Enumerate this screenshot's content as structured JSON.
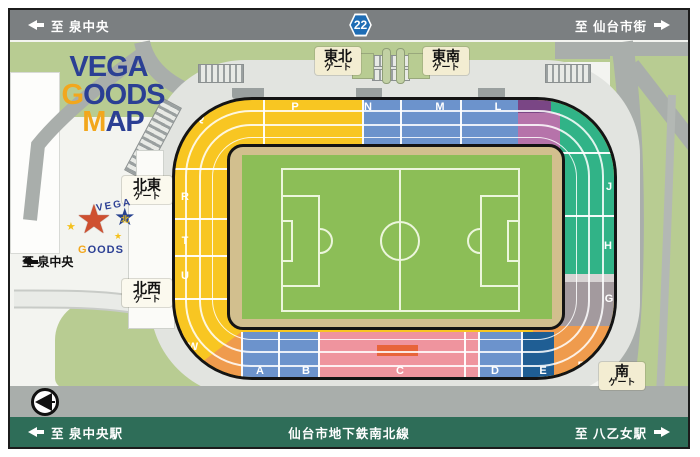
{
  "top_bar": {
    "left_label": "至 泉中央",
    "route_number": "22",
    "right_label": "至 仙台市街"
  },
  "map_title": {
    "vega": "VEGA",
    "g": "G",
    "oods": "OODS",
    "m": "M",
    "ap": "AP"
  },
  "gates": {
    "tohoku": {
      "name": "東北",
      "suffix": "ゲート"
    },
    "tonan": {
      "name": "東南",
      "suffix": "ゲート"
    },
    "hokuto": {
      "name": "北東",
      "suffix": "ゲート"
    },
    "hokusei": {
      "name": "北西",
      "suffix": "ゲート"
    },
    "minami": {
      "name": "南",
      "suffix": "ゲート"
    }
  },
  "street_label": "至 泉中央",
  "mascot": {
    "arc_text": "VEGA",
    "g": "G",
    "oods": "OODS",
    "north_star": "北"
  },
  "stand_sections": {
    "P": "P",
    "N": "N",
    "M": "M",
    "L": "L",
    "K": "K",
    "J": "J",
    "H": "H",
    "G": "G",
    "F": "F",
    "E": "E",
    "D": "D",
    "C": "C",
    "B": "B",
    "A": "A",
    "W": "W",
    "U": "U",
    "T": "T",
    "R": "R",
    "Q": "Q"
  },
  "bottom_bar": {
    "left_label": "至 泉中央駅",
    "center_label": "仙台市地下鉄南北線",
    "right_label": "至 八乙女駅"
  },
  "colors": {
    "bar_gray": "#7b7f81",
    "bar_green": "#2e6d58",
    "stand_yellow": "#f8c622",
    "stand_orange": "#ef9b4d",
    "stand_blue": "#6c93cc",
    "stand_dark_blue": "#1f5e94",
    "stand_pink": "#ef949e",
    "stand_red": "#e8643a",
    "stand_purple": "#7a4685",
    "stand_magenta": "#b673aa",
    "stand_green": "#31b387",
    "stand_gray": "#a39a9e",
    "pitch_green": "#8cbe57",
    "track_tan": "#d2bf8e",
    "grass_green": "#b8cc92",
    "road_gray": "#a9aeab",
    "badge_blue": "#1e6db5"
  }
}
